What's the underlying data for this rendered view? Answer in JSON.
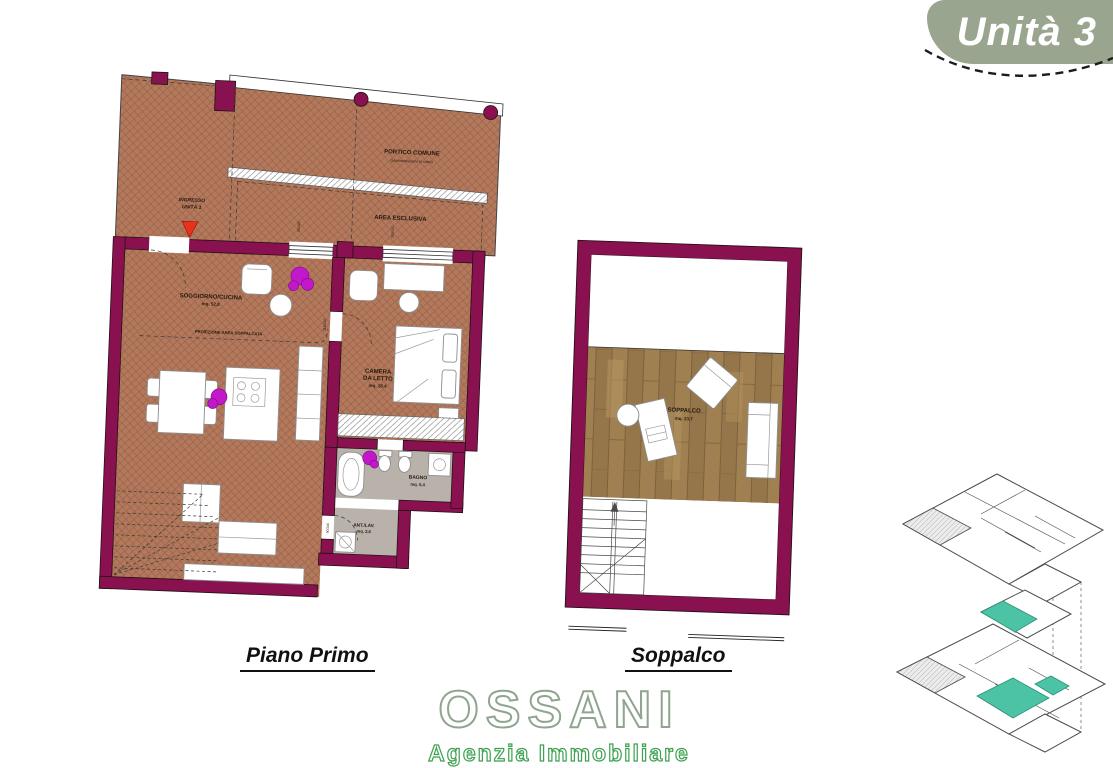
{
  "badge": {
    "label": "Unità 3"
  },
  "plans": {
    "piano_primo": {
      "title": "Piano Primo",
      "portico": {
        "label": "PORTICO COMUNE",
        "sublabel": "(pavimentazione in cotto)"
      },
      "area_esclusiva": {
        "label": "AREA ESCLUSIVA"
      },
      "ingresso": {
        "line1": "INGRESSO",
        "line2": "UNITÀ 3"
      },
      "soggiorno": {
        "label": "SOGGIORNO/CUCINA",
        "area": "mq. 52,8"
      },
      "proiezione": {
        "label": "PROIEZIONE AREA SOPPALCATA"
      },
      "camera": {
        "line1": "CAMERA",
        "line2": "DA LETTO",
        "area": "mq. 18,4"
      },
      "bagno": {
        "label": "BAGNO",
        "area": "mq. 5,4"
      },
      "antilav": {
        "label": "ANT./LAV.",
        "area": "mq. 2,6"
      },
      "dims": {
        "d1": "115/247",
        "d2": "115/247",
        "d3": "90/240",
        "d4": "90/429",
        "d5": "205/427"
      }
    },
    "soppalco": {
      "title": "Soppalco",
      "room": {
        "label": "SOPPALCO",
        "area": "mq. 23,7"
      }
    }
  },
  "logo": {
    "name": "OSSANI",
    "tagline": "Agenzia Immobiliare"
  },
  "colors": {
    "wall": "#8a1150",
    "terracotta": "#b3795c",
    "wood": "#9d7d4f",
    "badge_green": "#99a58e",
    "logo_green": "#3da050",
    "highlight_teal": "#4cc3a5",
    "plant_magenta": "#c318c9",
    "entry_red": "#e8311a"
  }
}
